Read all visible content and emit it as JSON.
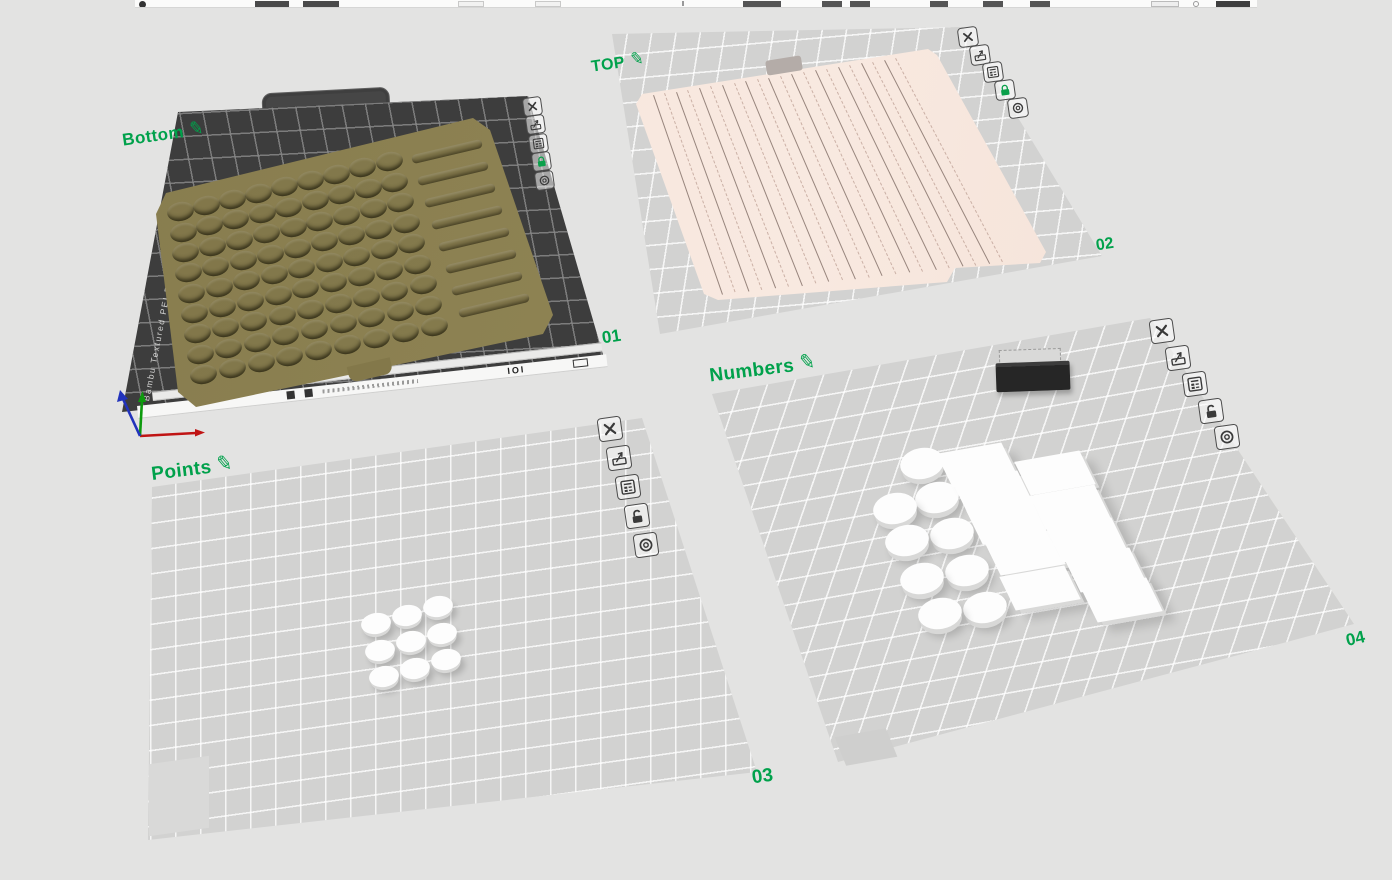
{
  "labels": {
    "edit_glyph": "✎"
  },
  "plate_buttons": [
    "close",
    "plate-preview",
    "plate-settings",
    "lock",
    "plate-config"
  ],
  "plates": [
    {
      "number": "01",
      "name": "Bottom",
      "locked": true,
      "bed_type_label": "Bambu Textured PEI Plate",
      "front_edge_marks": "IOI",
      "content": {
        "type": "tray",
        "color": "#8b8050",
        "hole_rows": 9,
        "hole_cols": 9,
        "slot_count": 8
      }
    },
    {
      "number": "02",
      "name": "TOP",
      "locked": true,
      "content": {
        "type": "slat_panel",
        "color": "#f7e5dc",
        "groove_count": 11
      }
    },
    {
      "number": "03",
      "name": "Points",
      "locked": false,
      "content": {
        "type": "cylinder_grid",
        "color": "#ffffff",
        "rows": 3,
        "cols": 3,
        "count": 9
      }
    },
    {
      "number": "04",
      "name": "Numbers",
      "locked": false,
      "content": {
        "type": "mixed",
        "cylinder_count": 9,
        "tile_count": 10,
        "dark_box_count": 1,
        "cylinder_color": "#ffffff",
        "tile_color": "#ffffff",
        "dark_box_color": "#282828"
      }
    }
  ],
  "colors": {
    "background": "#e3e3e2",
    "accent_green": "#00a14b",
    "bed_dark": "#3d3d3d",
    "bed_light": "#d2d2d1",
    "grid_line_light": "#ebebea",
    "grid_line_dark": "#6e6e6e",
    "tray": "#8b8050",
    "panel": "#f7e5dc"
  }
}
